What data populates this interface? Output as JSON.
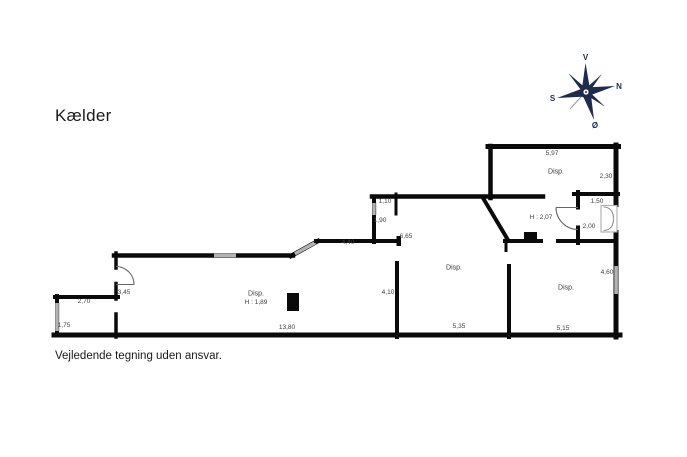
{
  "title": "Kælder",
  "disclaimer": "Vejledende tegning uden ansvar.",
  "compass": {
    "west": "V",
    "north": "N",
    "south": "S",
    "east": "Ø"
  },
  "colors": {
    "wall": "#0a0a0a",
    "window": "#b3b3b3",
    "door": "#666666",
    "compass": "#1e2b4d",
    "label": "#3f3f3f"
  },
  "plan": {
    "floor_name": "Kælder",
    "labels": [
      {
        "text": "5,97",
        "kind": "dimension"
      },
      {
        "text": "Disp.",
        "kind": "room"
      },
      {
        "text": "2,30",
        "kind": "dimension"
      },
      {
        "text": "1,10",
        "kind": "dimension"
      },
      {
        "text": "1,50",
        "kind": "dimension"
      },
      {
        "text": "1,90",
        "kind": "dimension"
      },
      {
        "text": "H : 2,07",
        "kind": "ceiling-height"
      },
      {
        "text": "2,00",
        "kind": "dimension"
      },
      {
        "text": "6,65",
        "kind": "dimension"
      },
      {
        "text": "4,40",
        "kind": "dimension"
      },
      {
        "text": "Disp.",
        "kind": "room"
      },
      {
        "text": "4,60",
        "kind": "dimension"
      },
      {
        "text": "3,45",
        "kind": "dimension"
      },
      {
        "text": "Disp.",
        "kind": "room"
      },
      {
        "text": "H : 1,89",
        "kind": "ceiling-height"
      },
      {
        "text": "2,70",
        "kind": "dimension"
      },
      {
        "text": "Disp.",
        "kind": "room"
      },
      {
        "text": "4,10",
        "kind": "dimension"
      },
      {
        "text": "1,75",
        "kind": "dimension"
      },
      {
        "text": "13,80",
        "kind": "dimension"
      },
      {
        "text": "5,35",
        "kind": "dimension"
      },
      {
        "text": "5,15",
        "kind": "dimension"
      }
    ]
  }
}
